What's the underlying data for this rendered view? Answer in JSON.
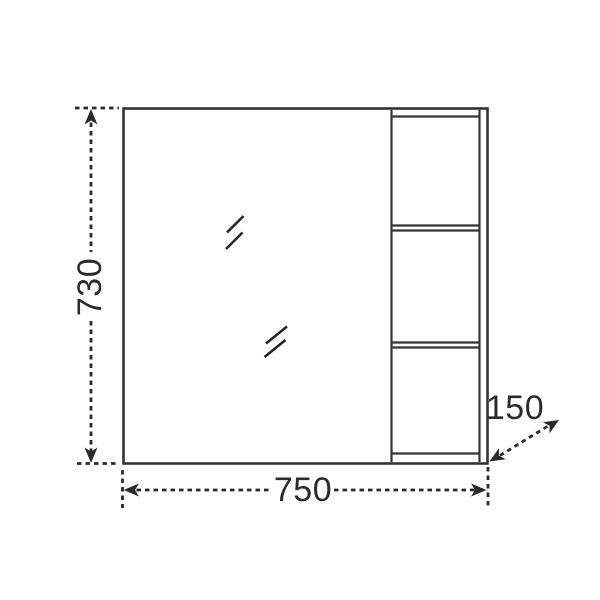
{
  "colors": {
    "background": "#ffffff",
    "cabinet_line": "#333333",
    "dimension_line": "#2a2a2a",
    "label_text": "#2b2b2b"
  },
  "diagram": {
    "labels": {
      "height": "730",
      "width": "750",
      "depth": "150"
    }
  }
}
